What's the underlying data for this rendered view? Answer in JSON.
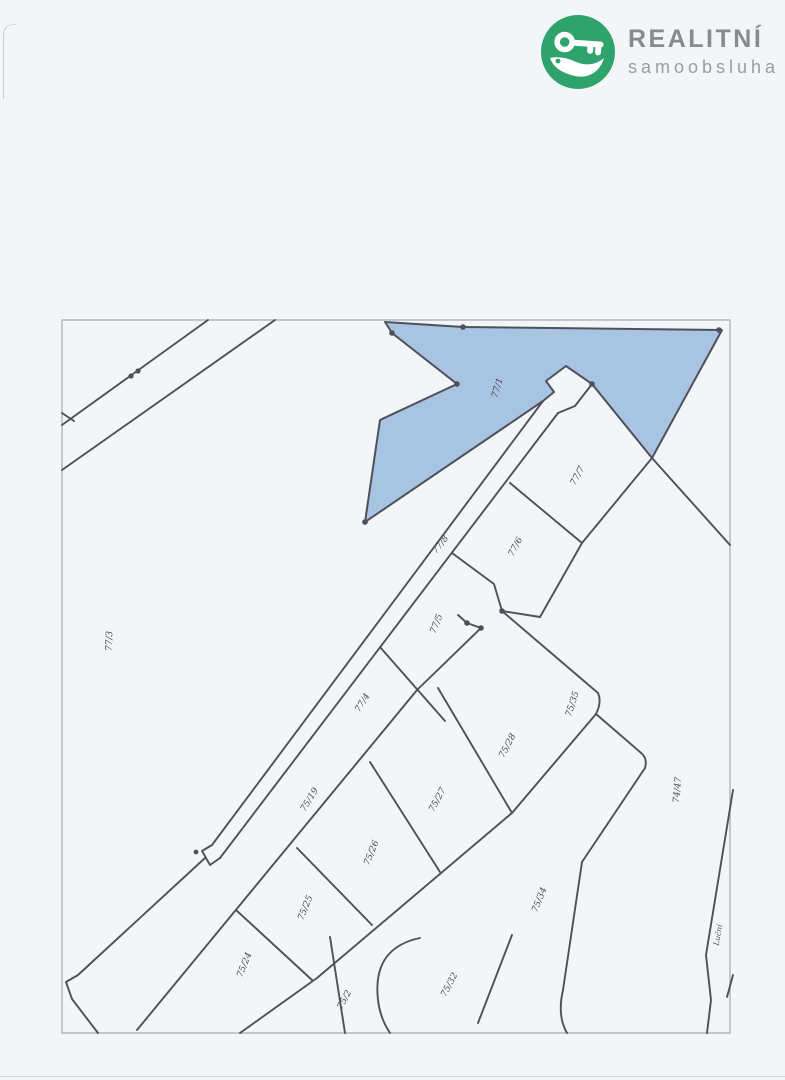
{
  "brand": {
    "name": "REALITNÍ",
    "subtitle": "samoobsluha",
    "icon": "crocodile-key-icon",
    "icon_color": "#2ea36c",
    "name_color": "#878b8f",
    "subtitle_color": "#989da1"
  },
  "map": {
    "type": "cadastral-parcel-map",
    "highlighted_parcel": "77/1",
    "highlight_fill": "#a7c4e3",
    "line_color": "#51505a",
    "frame_color": "#a9aeb5",
    "paper_color": "#f3f6f8",
    "street_label": {
      "text": "Luční",
      "x": 718,
      "y": 935,
      "rot": -80
    },
    "parcels": [
      {
        "id": "77/1",
        "x": 498,
        "y": 388,
        "rot": -73,
        "highlighted": true
      },
      {
        "id": "77/7",
        "x": 578,
        "y": 476,
        "rot": -62
      },
      {
        "id": "77/6",
        "x": 516,
        "y": 547,
        "rot": -62
      },
      {
        "id": "77/8",
        "x": 441,
        "y": 545,
        "rot": -52
      },
      {
        "id": "77/5",
        "x": 437,
        "y": 624,
        "rot": -68
      },
      {
        "id": "77/4",
        "x": 363,
        "y": 703,
        "rot": -58
      },
      {
        "id": "77/3",
        "x": 110,
        "y": 641,
        "rot": -88
      },
      {
        "id": "75/19",
        "x": 310,
        "y": 800,
        "rot": -58
      },
      {
        "id": "75/28",
        "x": 508,
        "y": 746,
        "rot": -62
      },
      {
        "id": "75/35",
        "x": 573,
        "y": 704,
        "rot": -72
      },
      {
        "id": "75/27",
        "x": 438,
        "y": 800,
        "rot": -62
      },
      {
        "id": "75/26",
        "x": 372,
        "y": 853,
        "rot": -68
      },
      {
        "id": "75/25",
        "x": 306,
        "y": 908,
        "rot": -68
      },
      {
        "id": "75/24",
        "x": 245,
        "y": 965,
        "rot": -68
      },
      {
        "id": "75/34",
        "x": 540,
        "y": 900,
        "rot": -68
      },
      {
        "id": "75/32",
        "x": 450,
        "y": 985,
        "rot": -62
      },
      {
        "id": "75/2",
        "x": 345,
        "y": 1000,
        "rot": -62
      },
      {
        "id": "74/47",
        "x": 678,
        "y": 790,
        "rot": -85
      }
    ]
  }
}
